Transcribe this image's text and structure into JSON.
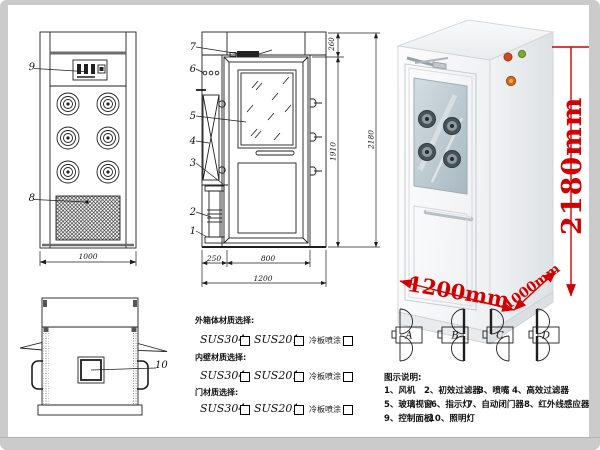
{
  "front_view": {
    "label_control_panel": "9",
    "label_grille": "8",
    "dim_width": "1000"
  },
  "section_view": {
    "part_labels": [
      "7",
      "6",
      "5",
      "4",
      "3",
      "2",
      "1"
    ],
    "dim_top": "260",
    "dim_door_height": "1910",
    "dim_total_height": "2180",
    "dim_left": "250",
    "dim_door_width": "800",
    "dim_total_width": "1200"
  },
  "top_view": {
    "label_lamp": "10"
  },
  "photo": {
    "dim_height": "2180mm",
    "dim_width": "1200mm",
    "dim_depth": "1000mm",
    "dim_color": "#d40000"
  },
  "door_options": {
    "types": [
      "A",
      "B",
      "C",
      "D"
    ]
  },
  "materials": {
    "sections": [
      {
        "title": "外箱体材质选择:",
        "options": [
          "SUS304",
          "SUS201",
          "冷板喷涂"
        ]
      },
      {
        "title": "内壁材质选择:",
        "options": [
          "SUS304",
          "SUS201",
          "冷板喷涂"
        ]
      },
      {
        "title": "门材质选择:",
        "options": [
          "SUS304",
          "SUS201",
          "冷板喷涂"
        ]
      }
    ]
  },
  "legend": {
    "title": "图示说明:",
    "rows": [
      [
        "1、风机",
        "2、初效过滤器",
        "3、喷嘴",
        "4、高效过滤器"
      ],
      [
        "5、玻璃视窗",
        "6、指示灯",
        "7、自动闭门器",
        "8、红外线感应器"
      ],
      [
        "9、控制面板",
        "10、照明灯"
      ]
    ]
  }
}
